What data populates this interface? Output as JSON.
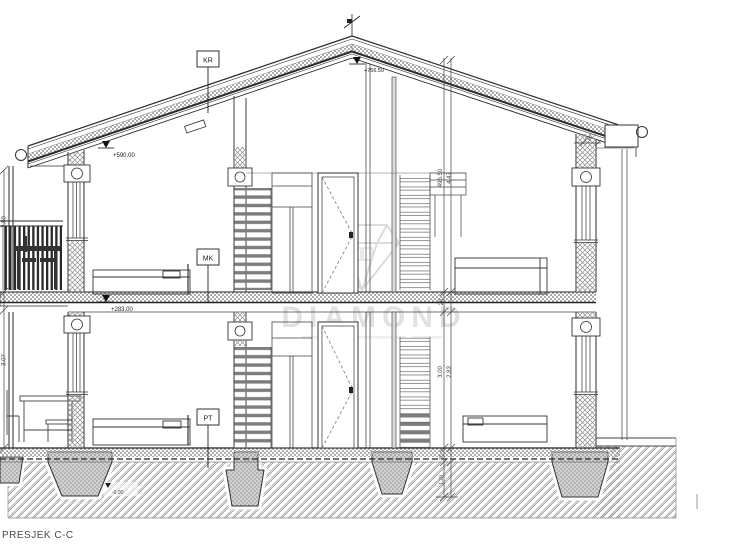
{
  "title": "PRESJEK C-C",
  "watermark": {
    "text": "DIAMOND"
  },
  "labels": {
    "roof": "KR",
    "floor": "MK",
    "ground": "PT"
  },
  "elevations": {
    "ridge": "+756.50",
    "eave_left": "+590.00",
    "first_floor": "+283.00",
    "footing": "-0.90"
  },
  "dimensions": {
    "right_total": "496.50",
    "right_height": "4.47",
    "slab_thickness": "20",
    "storey_height": "3.00",
    "clear_height": "2.83",
    "left_upper": "2.80",
    "left_lower": "3.07",
    "eave_offset": "63",
    "foundation_depth": "35",
    "foundation_width": "1.20"
  },
  "colors": {
    "line": "#2b2b2b",
    "hatch": "#9b9b9b",
    "watermark": "#dcdcdc"
  }
}
